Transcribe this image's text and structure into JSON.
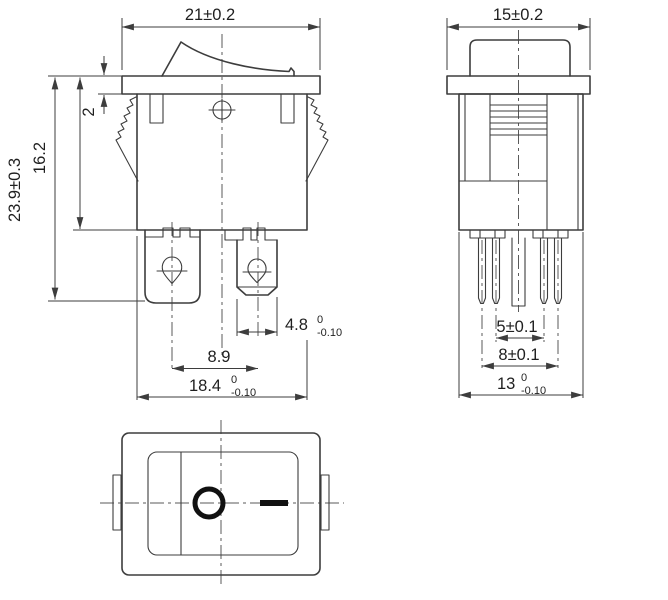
{
  "drawing": {
    "component": "rocker-switch",
    "style": {
      "line_color": "#3d3d3d",
      "centerline_color": "#5a5a5a",
      "text_color": "#1f1f1f",
      "background": "#ffffff",
      "symbol_color": "#111111"
    },
    "views": {
      "front": {
        "label": "front-view",
        "dimensions": {
          "top_width": "21±0.2",
          "overall_height": "23.9±0.3",
          "body_height": "16.2",
          "flange_thickness": "2",
          "terminal_width": {
            "value": "4.8",
            "upper": "0",
            "lower": "-0.10"
          },
          "terminal_pitch": "8.9",
          "body_width": {
            "value": "18.4",
            "upper": "0",
            "lower": "-0.10"
          }
        }
      },
      "side": {
        "label": "side-view",
        "dimensions": {
          "top_width": "15±0.2",
          "inner_pin_pitch": "5±0.1",
          "outer_pin_pitch": "8±0.1",
          "body_depth": {
            "value": "13",
            "upper": "0",
            "lower": "-0.10"
          }
        }
      },
      "bottom": {
        "label": "bottom-view",
        "markings": {
          "on_symbol": "O",
          "off_symbol": "—"
        }
      }
    }
  }
}
